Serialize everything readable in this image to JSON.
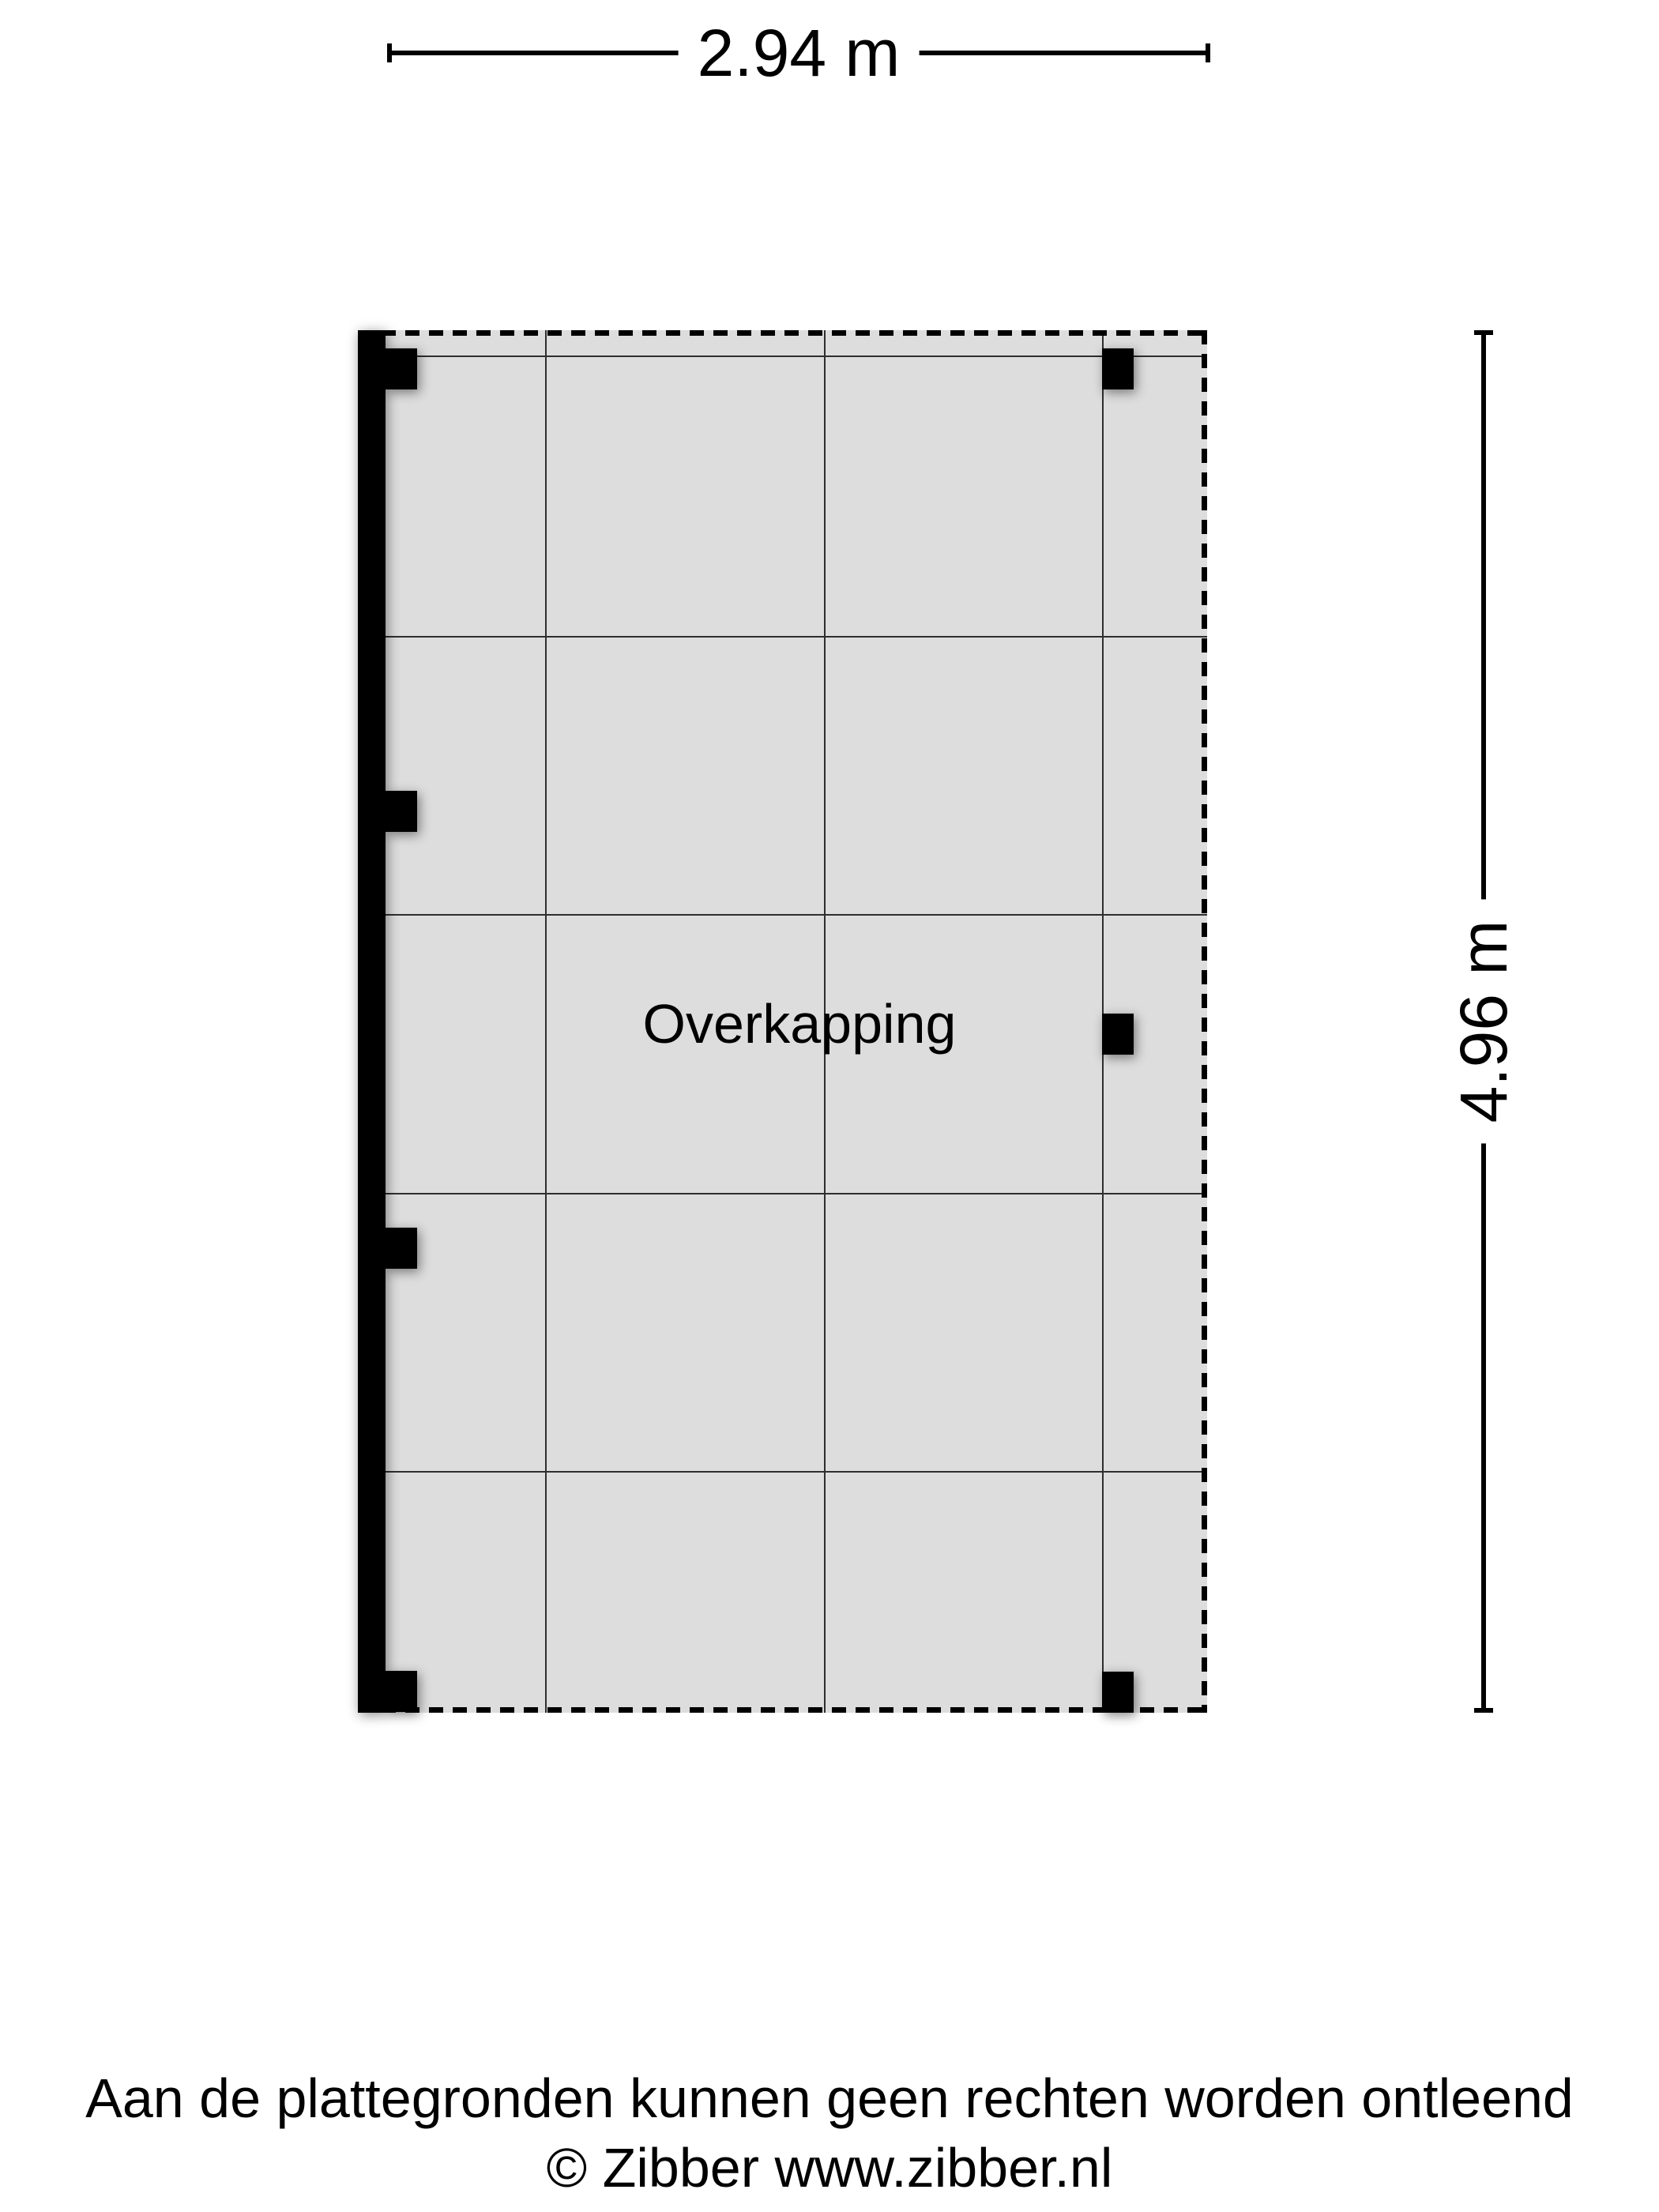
{
  "dimensions": {
    "width_label": "2.94 m",
    "height_label": "4.96 m"
  },
  "room": {
    "label": "Overkapping"
  },
  "footer": {
    "disclaimer": "Aan de plattegronden kunnen geen rechten worden ontleend",
    "copyright": "© Zibber www.zibber.nl"
  },
  "colors": {
    "background": "#ffffff",
    "floor_fill": "#dddddd",
    "grid_line": "#2e2e2e",
    "structure": "#000000",
    "text": "#000000"
  }
}
